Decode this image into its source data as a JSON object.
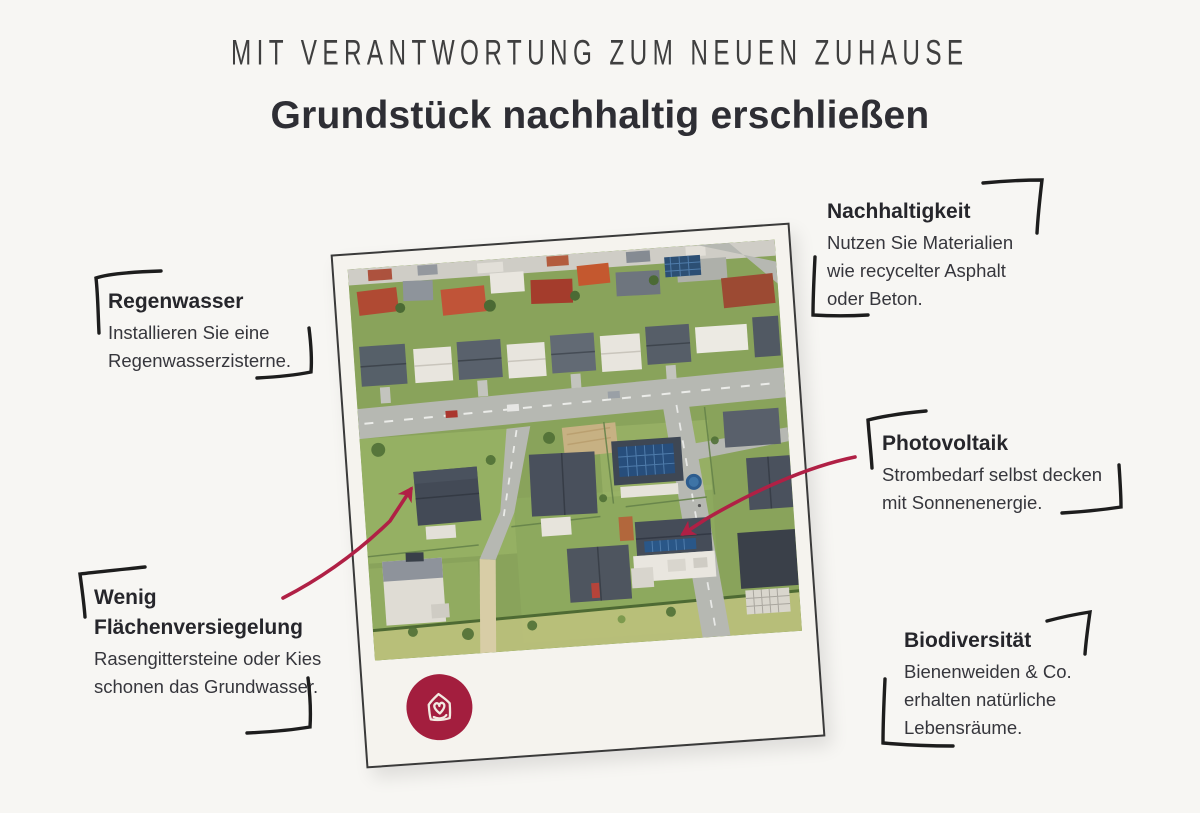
{
  "header": {
    "kicker": "MIT VERANTWORTUNG ZUM NEUEN ZUHAUSE",
    "title": "Grundstück nachhaltig erschließen"
  },
  "callouts": [
    {
      "id": "regenwasser",
      "title": "Regenwasser",
      "body": "Installieren Sie eine Regenwasserzisterne."
    },
    {
      "id": "flaechenversiegelung",
      "title": "Wenig Flächenversiegelung",
      "body": "Rasengittersteine oder Kies schonen das Grundwasser."
    },
    {
      "id": "nachhaltigkeit",
      "title": "Nachhaltigkeit",
      "body": "Nutzen Sie Materialien wie recycelter Asphalt oder Beton."
    },
    {
      "id": "photovoltaik",
      "title": "Photovoltaik",
      "body": "Strombedarf selbst decken mit Sonnenenergie."
    },
    {
      "id": "biodiversitaet",
      "title": "Biodiversität",
      "body": "Bienenweiden & Co. erhalten natürliche Lebensräume."
    }
  ],
  "photo": {
    "style": "polaroid",
    "description": "aerial view of a suburban single-family housing area",
    "logo_icon": "house-heart-logo"
  },
  "colors": {
    "accent_red": "#b02045",
    "logo_red": "#a31e3e",
    "ink": "#1d1d1d",
    "heading": "#2e2e34",
    "page_bg": "#f7f6f3",
    "polaroid_bg": "#f5f3ee"
  }
}
